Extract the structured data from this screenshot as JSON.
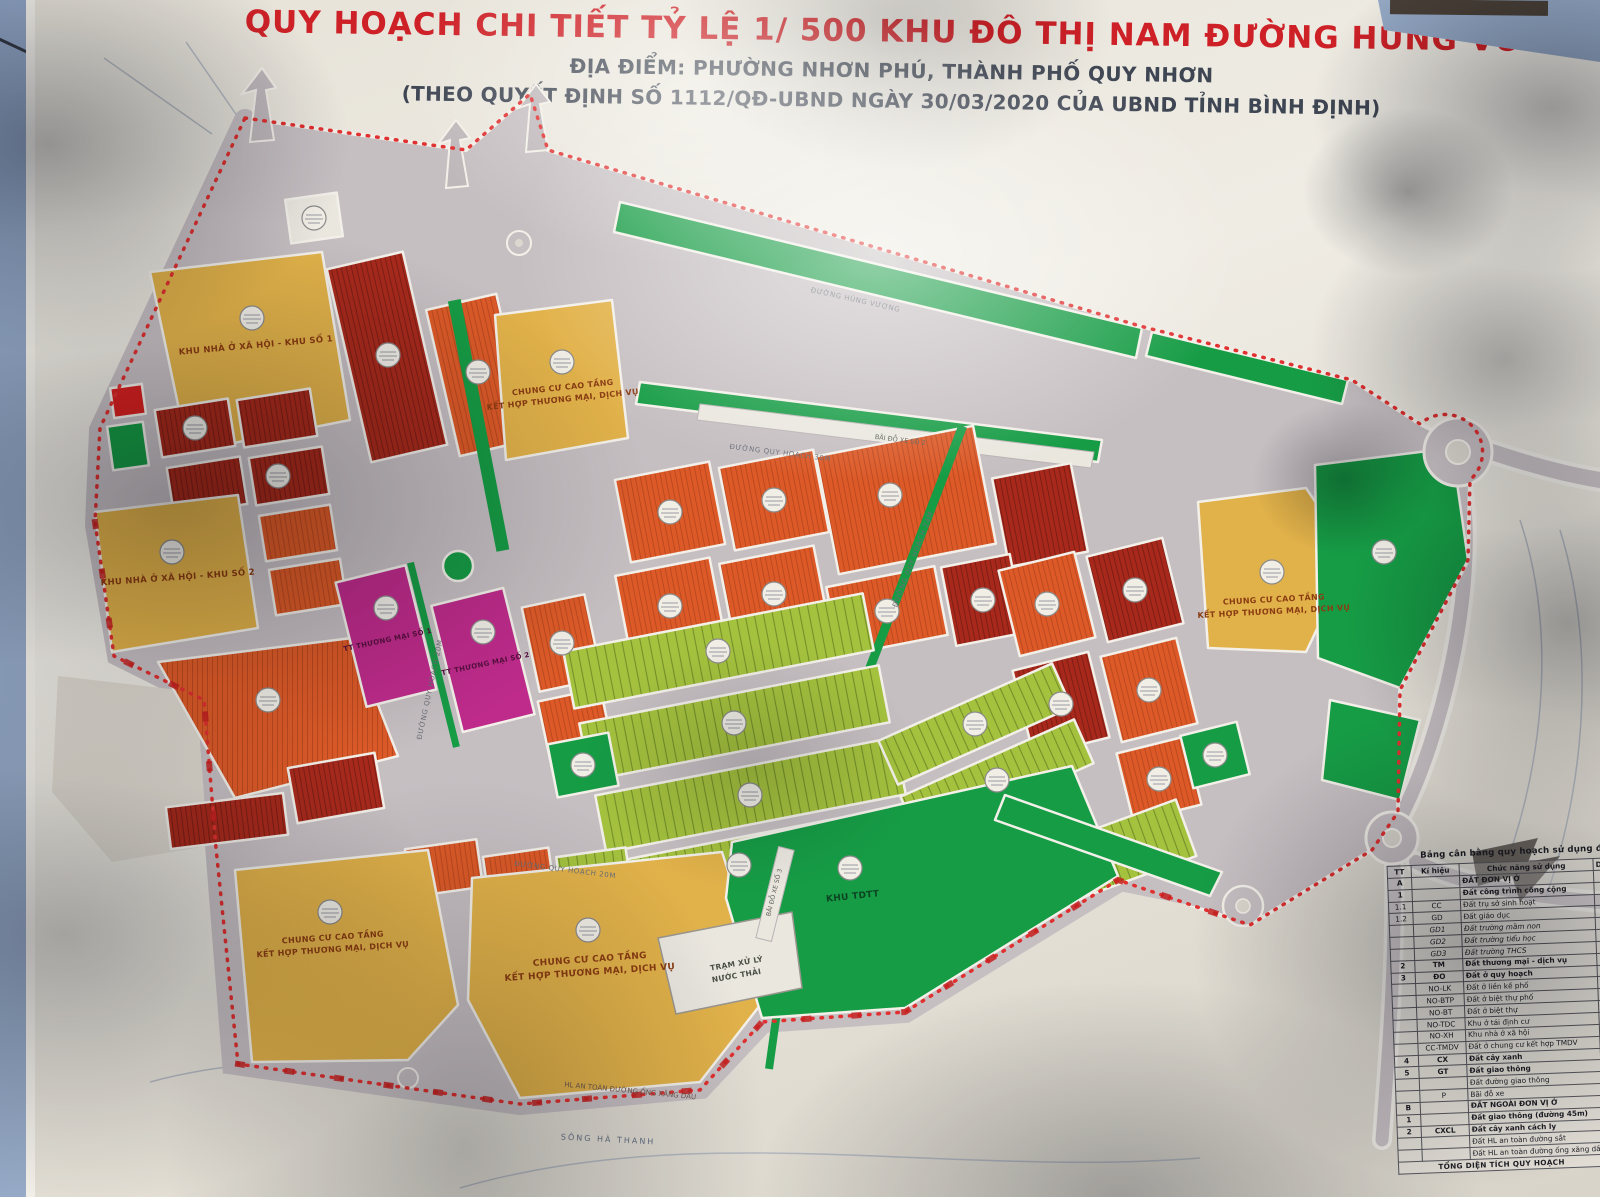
{
  "poster": {
    "title": "QUY HOẠCH CHI TIẾT TỶ LỆ 1/ 500 KHU ĐÔ THỊ NAM ĐƯỜNG HÙNG VƯƠNG",
    "subtitle": "ĐỊA ĐIỂM: PHƯỜNG NHƠN PHÚ, THÀNH PHỐ QUY NHƠN",
    "decision": "(THEO QUYẾT ĐỊNH SỐ 1112/QĐ-UBND NGÀY 30/03/2020 CỦA UBND TỈNH BÌNH ĐỊNH)",
    "title_color": "#ce2127",
    "subtitle_color": "#3f4653"
  },
  "map": {
    "colors": {
      "orange": "#dd5a28",
      "dark_red": "#a8291c",
      "yellow": "#e2b24a",
      "green": "#169c45",
      "light_green": "#a5c23e",
      "magenta": "#bf2b8b",
      "red": "#d92020",
      "road": "#c6bfc2",
      "boundary_red": "#d42525"
    },
    "zones": {
      "xh1": {
        "label": "KHU NHÀ Ở XÃ HỘI - KHU SỐ 1"
      },
      "xh2": {
        "label": "KHU NHÀ Ở XÃ HỘI - KHU SỐ 2"
      },
      "ccct": {
        "line1": "CHUNG CƯ CAO TẦNG",
        "line2": "KẾT HỢP THƯƠNG MẠI, DỊCH VỤ"
      },
      "tm1": {
        "label": "TT THƯƠNG MẠI SỐ 1"
      },
      "tm2": {
        "label": "TT THƯƠNG MẠI SỐ 2"
      },
      "tdtt": {
        "label": "KHU TDTT"
      },
      "wwtp": {
        "line1": "TRẠM XỬ LÝ",
        "line2": "NƯỚC THẢI"
      }
    },
    "roads": {
      "hung_vuong": "ĐƯỜNG HÙNG VƯƠNG",
      "r30": "ĐƯỜNG QUY HOẠCH 30M",
      "r24": "ĐƯỜNG QUY HOẠCH 24M",
      "r20": "ĐƯỜNG QUY HOẠCH 20M"
    },
    "annotations": {
      "river": "SÔNG HÀ THANH",
      "parking_top": "BÃI ĐỖ XE SỐ 2",
      "parking_mid": "BÃI ĐỖ XE SỐ 3",
      "pipeline": "HL AN TOÀN ĐƯỜNG ỐNG XĂNG DẦU"
    }
  },
  "legend": {
    "title": "Bảng cân bằng quy hoạch sử dụng đất",
    "columns": {
      "tt": "TT",
      "key": "Kí hiệu",
      "func": "Chức năng sử dụng",
      "area": "Diện tích (m2)"
    },
    "rows": [
      {
        "tt": "A",
        "k": "",
        "f": "ĐẤT ĐƠN VỊ Ở",
        "a": "417.46",
        "cls": "b"
      },
      {
        "tt": "1",
        "k": "",
        "f": "Đất công trình công cộng",
        "a": "34.17",
        "cls": "b"
      },
      {
        "tt": "1.1",
        "k": "CC",
        "f": "Đất trụ sở sinh hoạt",
        "a": "1.9",
        "cls": ""
      },
      {
        "tt": "1.2",
        "k": "GD",
        "f": "Đất giáo dục",
        "a": "13.1",
        "cls": ""
      },
      {
        "tt": "",
        "k": "GD1",
        "f": "Đất trường mầm non",
        "a": "6.5",
        "cls": "i"
      },
      {
        "tt": "",
        "k": "GD2",
        "f": "Đất trường tiểu học",
        "a": "4.6",
        "cls": "i"
      },
      {
        "tt": "",
        "k": "GD3",
        "f": "Đất trường THCS",
        "a": "12.1",
        "cls": "i"
      },
      {
        "tt": "2",
        "k": "TM",
        "f": "Đất thương mại - dịch vụ",
        "a": "10.4",
        "cls": "b"
      },
      {
        "tt": "3",
        "k": "ĐO",
        "f": "Đất ở quy hoạch",
        "a": "325.",
        "cls": "b"
      },
      {
        "tt": "",
        "k": "NO-LK",
        "f": "Đất ở liền kề phố",
        "a": "128",
        "cls": ""
      },
      {
        "tt": "",
        "k": "NO-BTP",
        "f": "Đất ở biệt thự phố",
        "a": "11",
        "cls": ""
      },
      {
        "tt": "",
        "k": "NO-BT",
        "f": "Đất ở biệt thự",
        "a": "11",
        "cls": ""
      },
      {
        "tt": "",
        "k": "NO-TDC",
        "f": "Khu ở tái định cư",
        "a": "4",
        "cls": ""
      },
      {
        "tt": "",
        "k": "NO-XH",
        "f": "Khu nhà ở xã hội",
        "a": "",
        "cls": ""
      },
      {
        "tt": "",
        "k": "CC-TMDV",
        "f": "Đất ở chung cư kết hợp TMDV",
        "a": "",
        "cls": ""
      },
      {
        "tt": "4",
        "k": "CX",
        "f": "Đất cây xanh",
        "a": "",
        "cls": "b"
      },
      {
        "tt": "5",
        "k": "GT",
        "f": "Đất giao thông",
        "a": "",
        "cls": "b"
      },
      {
        "tt": "",
        "k": "",
        "f": "Đất đường giao thông",
        "a": "",
        "cls": ""
      },
      {
        "tt": "",
        "k": "P",
        "f": "Bãi đỗ xe",
        "a": "",
        "cls": ""
      },
      {
        "tt": "B",
        "k": "",
        "f": "ĐẤT NGOÀI ĐƠN VỊ Ở",
        "a": "",
        "cls": "b"
      },
      {
        "tt": "1",
        "k": "",
        "f": "Đất giao thông (đường 45m)",
        "a": "",
        "cls": "b"
      },
      {
        "tt": "2",
        "k": "CXCL",
        "f": "Đất cây xanh cách ly",
        "a": "",
        "cls": "b"
      },
      {
        "tt": "",
        "k": "",
        "f": "Đất HL an toàn đường sắt",
        "a": "",
        "cls": ""
      },
      {
        "tt": "",
        "k": "",
        "f": "Đất HL an toàn đường ống xăng dầu",
        "a": "",
        "cls": ""
      }
    ],
    "footer": "TỔNG DIỆN TÍCH QUY HOẠCH"
  }
}
